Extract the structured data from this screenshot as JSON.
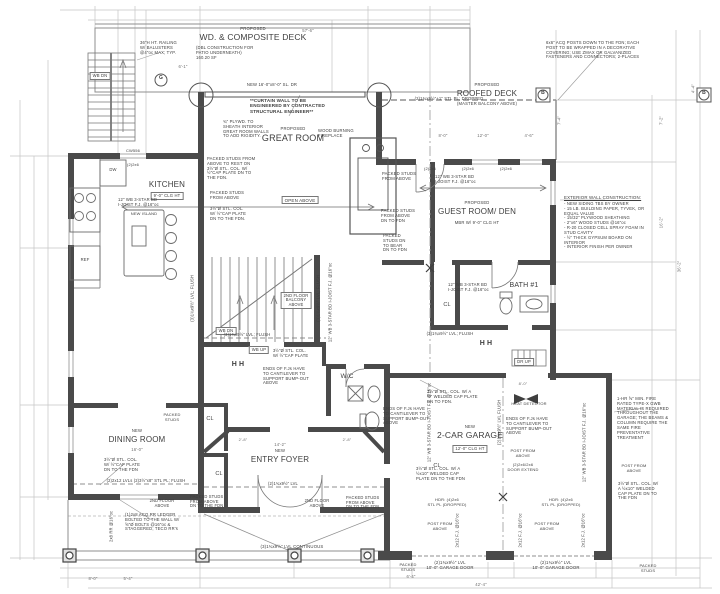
{
  "colors": {
    "paper": "#ffffff",
    "wall_ink": "#4a4a4a",
    "line": "#8f8f8f",
    "dim_line": "#c4c4c4",
    "text": "#3d3d3d"
  },
  "labels": [
    {
      "n": "deck-proposed",
      "t": "PROPOSED",
      "x": 253,
      "y": 27,
      "s": 4.3
    },
    {
      "n": "deck-title",
      "t": "WD. & COMPOSITE DECK",
      "x": 253,
      "y": 33,
      "s": 8.5
    },
    {
      "n": "deck-sub",
      "t": "(DBL CONSTRUCTION FOR\nPATIO UNDERNEATH)\n160.20 SF",
      "x": 236,
      "y": 46,
      "s": 4.2,
      "al": "l",
      "w": 80
    },
    {
      "n": "roofed-deck-proposed",
      "t": "PROPOSED",
      "x": 487,
      "y": 83,
      "s": 4.2
    },
    {
      "n": "roofed-deck-title",
      "t": "ROOFED DECK",
      "x": 487,
      "y": 89,
      "s": 8
    },
    {
      "n": "roofed-deck-sub",
      "t": "(MASTER BALCONY ABOVE)",
      "x": 487,
      "y": 102,
      "s": 4.2
    },
    {
      "n": "great-room-proposed",
      "t": "PROPOSED",
      "x": 293,
      "y": 127,
      "s": 4.2
    },
    {
      "n": "great-room-title",
      "t": "GREAT ROOM",
      "x": 293,
      "y": 133,
      "s": 9
    },
    {
      "n": "open-above-tag",
      "t": "OPEN ABOVE",
      "x": 300,
      "y": 196,
      "s": 4.5,
      "box": 1
    },
    {
      "n": "kitchen-title",
      "t": "KITCHEN",
      "x": 167,
      "y": 180,
      "s": 8
    },
    {
      "n": "kitchen-clg-tag",
      "t": "9'-0\" CLG HT",
      "x": 167,
      "y": 192,
      "s": 4.2,
      "box": 1
    },
    {
      "n": "guest-proposed",
      "t": "PROPOSED",
      "x": 477,
      "y": 201,
      "s": 4.2
    },
    {
      "n": "guest-title",
      "t": "GUEST ROOM/ DEN",
      "x": 477,
      "y": 207,
      "s": 8
    },
    {
      "n": "guest-sub",
      "t": "MBR W/ 9'-0\" CLG HT",
      "x": 477,
      "y": 221,
      "s": 4.2
    },
    {
      "n": "bath1-title",
      "t": "BATH #1",
      "x": 524,
      "y": 282,
      "s": 7
    },
    {
      "n": "dining-new",
      "t": "NEW",
      "x": 137,
      "y": 429,
      "s": 4.2
    },
    {
      "n": "dining-title",
      "t": "DINING ROOM",
      "x": 137,
      "y": 435,
      "s": 8
    },
    {
      "n": "dining-dim",
      "t": "16'-0\"",
      "x": 137,
      "y": 448,
      "s": 4.2,
      "k": "dim"
    },
    {
      "n": "foyer-dim",
      "t": "14'-2\"",
      "x": 280,
      "y": 443,
      "s": 4.2,
      "k": "dim"
    },
    {
      "n": "foyer-new",
      "t": "NEW",
      "x": 280,
      "y": 449,
      "s": 4.2
    },
    {
      "n": "foyer-title",
      "t": "ENTRY FOYER",
      "x": 280,
      "y": 455,
      "s": 8
    },
    {
      "n": "garage-new",
      "t": "NEW",
      "x": 470,
      "y": 425,
      "s": 4.2
    },
    {
      "n": "garage-title",
      "t": "2-CAR GARAGE",
      "x": 470,
      "y": 431,
      "s": 8.5
    },
    {
      "n": "garage-clg-tag",
      "t": "12'-0\" CLG HT",
      "x": 470,
      "y": 445,
      "s": 4.2,
      "box": 1
    },
    {
      "n": "wc-title",
      "t": "W/C",
      "x": 347,
      "y": 373,
      "s": 6.5
    },
    {
      "n": "closet-tag-1",
      "t": "CL",
      "x": 210,
      "y": 416,
      "s": 5.5
    },
    {
      "n": "closet-tag-2",
      "t": "CL",
      "x": 219,
      "y": 471,
      "s": 5.5
    },
    {
      "n": "closet-tag-3",
      "t": "CL",
      "x": 447,
      "y": 302,
      "s": 5.5
    },
    {
      "n": "closet-tag-4",
      "t": "CL",
      "x": 437,
      "y": 463,
      "s": 5.5
    },
    {
      "n": "stair-ext-wb-dn",
      "t": "WB DN",
      "x": 100,
      "y": 72,
      "s": 4.2,
      "box": 1
    },
    {
      "n": "stair-wb-dn",
      "t": "WB DN",
      "x": 226,
      "y": 327,
      "s": 4.2,
      "box": 1
    },
    {
      "n": "stair-wb-up",
      "t": "WB UP",
      "x": 259,
      "y": 346,
      "s": 4.2,
      "box": 1
    },
    {
      "n": "stair-dr-up",
      "t": "DR UP",
      "x": 524,
      "y": 358,
      "s": 4.2,
      "box": 1
    },
    {
      "n": "note-curtain-wall",
      "t": "**CURTAIN WALL TO BE\nENGINEERED BY CONTRACTED\nSTRUCTURAL ENGINEER**",
      "x": 289,
      "y": 98,
      "s": 4.6,
      "b": 1,
      "al": "l",
      "w": 78
    },
    {
      "n": "note-railing",
      "t": "36\"H HT. RAILING\nW/ BALUSTERS\n@4\"oc MAX; TYP.",
      "x": 163,
      "y": 41,
      "s": 4.2,
      "al": "l",
      "w": 46
    },
    {
      "n": "note-plywood",
      "t": "¾\" PLYWD. TO\nSHEATH INTERIOR\nGREAT ROOM WALLS\nTO ADD RIGIDITY.",
      "x": 247,
      "y": 120,
      "s": 4.2,
      "al": "l",
      "w": 48
    },
    {
      "n": "note-packed-col-great",
      "t": "PACKED STUDS FROM\nABOVE TO REST ON\n3½\"Ø STL. COL. W/\n½\"CAP PLATE DN TO\nTHE FDN.",
      "x": 232,
      "y": 157,
      "s": 4.2,
      "al": "l",
      "w": 50
    },
    {
      "n": "note-packed-above-1",
      "t": "PACKED STUDS\nFROM ABOVE",
      "x": 230,
      "y": 191,
      "s": 4.2,
      "al": "l",
      "w": 40
    },
    {
      "n": "note-col-cap-1",
      "t": "3½\"Ø STL. COL.\nW/ ½\"CAP PLATE\nDN TO THE FDN.",
      "x": 230,
      "y": 207,
      "s": 4.2,
      "al": "l",
      "w": 40
    },
    {
      "n": "note-fireplace",
      "t": "WOOD BURNING\nFIREPLACE",
      "x": 337,
      "y": 129,
      "s": 4.2,
      "al": "l",
      "w": 38
    },
    {
      "n": "note-packed-above-2",
      "t": "PACKED STUDS\nFROM ABOVE",
      "x": 401,
      "y": 172,
      "s": 4.2,
      "al": "l",
      "w": 38
    },
    {
      "n": "note-packed-above-3",
      "t": "PACKED STUDS\nFROM ABOVE\nDN TO FDN",
      "x": 400,
      "y": 209,
      "s": 4.2,
      "al": "l",
      "w": 38
    },
    {
      "n": "note-packed-bear",
      "t": "PACKED\nSTUDS DN\nTO BEAR\nDN TO FDN",
      "x": 398,
      "y": 234,
      "s": 4.2,
      "al": "l",
      "w": 30
    },
    {
      "n": "note-sliding-door",
      "t": "NEW 16'-0\"x8'-0\" SL. DR",
      "x": 272,
      "y": 83,
      "s": 4.2
    },
    {
      "n": "note-dropped-plate",
      "t": "(2)1¾x9½\"+1\" STL PL; DROPPED",
      "x": 449,
      "y": 97,
      "s": 4.2
    },
    {
      "n": "note-acq-posts",
      "t": "6x6\" ACQ POSTS DOWN TO THE FDN; EACH\nPOST TO BE WRAPPED IN A DECORATIVE\nCOVERING; USE ZMAX OR GALVANIZED\nFASTENERS AND CONNECTORS; 2-PLACES",
      "x": 601,
      "y": 41,
      "s": 4.2,
      "al": "l",
      "w": 110
    },
    {
      "n": "note-extwall-title",
      "t": "EXTERIOR WALL CONSTRUCTION:",
      "x": 607,
      "y": 195,
      "s": 4.4,
      "u": 1,
      "al": "l",
      "w": 86
    },
    {
      "n": "note-extwall-body",
      "t": "- NEW SIDING TBS BY OWNER\n- 15 LB. BUILDING PAPER, TYVEK, OR\n  EQUAL VALUE\n- 15/32\" PLYWOOD SHEATHING\n- 2\"x6\" WOOD STUDS @16\"oc\n- R-20 CLOSED CELL SPRAY FOAM IN\n  STUD CAVITY\n- ½\" THICK GYPSUM BOARD ON INTERIOR\n- INTERIOR FINISH PER OWNER",
      "x": 607,
      "y": 202,
      "s": 4.2,
      "al": "l",
      "w": 86
    },
    {
      "n": "note-joist-kitchen",
      "t": "12\" WB 3-STAR BD\nI-JOIST F.J. @16\"oc",
      "x": 140,
      "y": 198,
      "s": 4.2,
      "al": "l",
      "w": 44
    },
    {
      "n": "note-joist-guest",
      "t": "12\" WB 3-STAR BD\nI-JOIST F.J. @16\"oc",
      "x": 457,
      "y": 175,
      "s": 4.2,
      "al": "l",
      "w": 44
    },
    {
      "n": "note-joist-hall",
      "t": "12\" WB 3-STAR BD\nI-JOIST F.J. @16\"oc",
      "x": 470,
      "y": 283,
      "s": 4.2,
      "al": "l",
      "w": 44
    },
    {
      "n": "note-joist-stair",
      "t": "12\" WB 3-STAR BD  I-JOIST F.J. @16\"oc",
      "x": 331,
      "y": 300,
      "s": 4.1,
      "r": -90
    },
    {
      "n": "note-joist-garage-left",
      "t": "12\" WB 3-STAR BD  I-JOIST F.J. @16\"oc",
      "x": 430,
      "y": 420,
      "s": 4.1,
      "r": -90
    },
    {
      "n": "note-joist-garage-right",
      "t": "12\" WB 3-STAR BD  I-JOIST F.J. @16\"oc",
      "x": 585,
      "y": 440,
      "s": 4.1,
      "r": -90
    },
    {
      "n": "note-cantilever-1",
      "t": "ENDS OF F.Js HAVE\nTO CANTILEVER TO\nSUPPORT BUMP-OUT\nABOVE",
      "x": 287,
      "y": 367,
      "s": 4.2,
      "al": "l",
      "w": 48
    },
    {
      "n": "note-cantilever-2",
      "t": "ENDS OF F.Js HAVE\nTO CANTILEVER TO\nSUPPORT BUMP-OUT\nABOVE",
      "x": 407,
      "y": 407,
      "s": 4.2,
      "al": "l",
      "w": 48
    },
    {
      "n": "note-cantilever-3",
      "t": "ENDS OF F.Js HAVE\nTO CANTILEVER TO\nSUPPORT BUMP-OUT\nABOVE",
      "x": 530,
      "y": 417,
      "s": 4.2,
      "al": "l",
      "w": 48
    },
    {
      "n": "heat-detector-label",
      "t": "HEAT DETECTOR",
      "x": 529,
      "y": 402,
      "s": 4
    },
    {
      "n": "note-fire-rated",
      "t": "1-HR ⅝\" MIN. FIRE\nRATED TYPE-X GWB\nMATERIAL IS REQUIRED\nTHROUGHOUT THE\nGARAGE; THE BEAMS &\nCOLUMN REQUIRE THE\nSAME FIRE\nPREVENTATIVE\nTREATMENT",
      "x": 645,
      "y": 397,
      "s": 4.2,
      "al": "l",
      "w": 56
    },
    {
      "n": "note-post-above-1",
      "t": "POST FROM\nABOVE",
      "x": 523,
      "y": 449,
      "s": 4
    },
    {
      "n": "note-door-extend",
      "t": "(2)2x6/2x6\nDOOR EXTEND",
      "x": 523,
      "y": 463,
      "s": 4
    },
    {
      "n": "note-post-above-2",
      "t": "POST FROM\nABOVE",
      "x": 440,
      "y": 522,
      "s": 4
    },
    {
      "n": "note-post-above-3",
      "t": "POST FROM\nABOVE",
      "x": 547,
      "y": 522,
      "s": 4
    },
    {
      "n": "note-post-above-4",
      "t": "POST FROM\nABOVE",
      "x": 634,
      "y": 464,
      "s": 4
    },
    {
      "n": "note-col-cap-2",
      "t": "3½\"Ø STL. COL. W/ A\n½\" WELDED CAP PLATE\nDN TO FDN.",
      "x": 453,
      "y": 390,
      "s": 4.2,
      "al": "l",
      "w": 52
    },
    {
      "n": "note-col-cap-3",
      "t": "3½\"Ø STL. COL. W/ A\n½x10\" WELDED CAP\nPLATE DN TO THE FDN",
      "x": 441,
      "y": 467,
      "s": 4.2,
      "al": "l",
      "w": 50
    },
    {
      "n": "note-col-cap-4",
      "t": "3½\"Ø STL. COL. W/\nA ½x10\" WELDED\nCAP PLATE DN TO\nTHE FDN",
      "x": 641,
      "y": 482,
      "s": 4.2,
      "al": "l",
      "w": 46
    },
    {
      "n": "note-col-cap-5",
      "t": "3½\"Ø STL. COL.\nW/ ½\"CAP PLATE\nDN TO THE FDN",
      "x": 124,
      "y": 458,
      "s": 4.2,
      "al": "l",
      "w": 40
    },
    {
      "n": "note-flush-2x12",
      "t": "(2)2x12 LVLs (2)3½\"x8\" STL PL; FLUSH",
      "x": 146,
      "y": 479,
      "s": 4.1
    },
    {
      "n": "note-lvl-flush-a",
      "t": "(3)1¾x9½\" LVL; FLUSH",
      "x": 247,
      "y": 333,
      "s": 4.1
    },
    {
      "n": "note-lvl-flush-b",
      "t": "(3)1¾x9½\" LVL; FLUSH",
      "x": 450,
      "y": 332,
      "s": 4.1
    },
    {
      "n": "note-col-cap-6",
      "t": "3½\"Ø STL. COL.\nW/ ½\"CAP PLATE",
      "x": 293,
      "y": 349,
      "s": 4.1,
      "al": "l",
      "w": 40
    },
    {
      "n": "note-lvl-rot-a",
      "t": "(3)1¾x9½\" LVL; FLUSH",
      "x": 193,
      "y": 296,
      "s": 4.1,
      "r": -90
    },
    {
      "n": "note-lvl-rot-b",
      "t": "(3)1¾x9½\" LVL; FLUSH",
      "x": 319,
      "y": 296,
      "s": 4.1,
      "r": -90
    },
    {
      "n": "note-balcony-above",
      "t": "2ND FLOOR\nBALCONY\nABOVE",
      "x": 296,
      "y": 292,
      "s": 4.1,
      "box": 1
    },
    {
      "n": "note-2nd-floor-1",
      "t": "2ND FLOOR\nABOVE",
      "x": 162,
      "y": 499,
      "s": 4.1
    },
    {
      "n": "note-2nd-floor-2",
      "t": "2ND FLOOR\nABOVE",
      "x": 317,
      "y": 499,
      "s": 4.1
    },
    {
      "n": "note-packed-fdn-1",
      "t": "PACKED STUDS\nFROM ABOVE\nDN TO THE FDN",
      "x": 209,
      "y": 495,
      "s": 4.1,
      "al": "l",
      "w": 38
    },
    {
      "n": "note-packed-fdn-2",
      "t": "PACKED STUDS\nFROM ABOVE\nDN TO THE FDN",
      "x": 365,
      "y": 496,
      "s": 4.1,
      "al": "l",
      "w": 38
    },
    {
      "n": "note-packed-studs-1",
      "t": "PACKED\nSTUDS",
      "x": 172,
      "y": 413,
      "s": 4
    },
    {
      "n": "note-packed-studs-2",
      "t": "PACKED\nSTUDS",
      "x": 408,
      "y": 563,
      "s": 4
    },
    {
      "n": "note-packed-studs-3",
      "t": "PACKED\nSTUDS",
      "x": 648,
      "y": 564,
      "s": 4
    },
    {
      "n": "note-ledger",
      "t": "(1)2x8 ACQ RR LEDGER\nBOLTED TO THE WALL W/\n⅝\"Ø BOLTS @16\"oc &\nSTAGGERED; TECO RR's",
      "x": 154,
      "y": 513,
      "s": 4.2,
      "al": "l",
      "w": 58
    },
    {
      "n": "note-rr-rot",
      "t": "2x8 RR @16\"oc",
      "x": 112,
      "y": 524,
      "s": 4.1,
      "r": -90
    },
    {
      "n": "note-porch-lvl",
      "t": "(3)1¾x9½\" LVL CONTINUOUS",
      "x": 292,
      "y": 545,
      "s": 4.3
    },
    {
      "n": "note-garage-door-1",
      "t": "(2)1¾x9½\" LVL\n10'-0\" GARAGE DOOR",
      "x": 450,
      "y": 561,
      "s": 4.3
    },
    {
      "n": "note-garage-door-2",
      "t": "(2)1¾x9½\" LVL\n10'-0\" GARAGE DOOR",
      "x": 556,
      "y": 561,
      "s": 4.3
    },
    {
      "n": "note-header-1",
      "t": "HDR: (4)2x6\nSTL PL (DROPPED)",
      "x": 447,
      "y": 498,
      "s": 4
    },
    {
      "n": "note-header-2",
      "t": "HDR: (4)2x6\nSTL PL (DROPPED)",
      "x": 561,
      "y": 498,
      "s": 4
    },
    {
      "n": "note-fj-rot-1",
      "t": "2x12 F.J. @16\"oc",
      "x": 458,
      "y": 528,
      "s": 4.1,
      "r": -90
    },
    {
      "n": "note-fj-rot-2",
      "t": "2x12 F.J. @16\"oc",
      "x": 521,
      "y": 528,
      "s": 4.1,
      "r": -90
    },
    {
      "n": "note-fj-rot-3",
      "t": "2x12 F.J. @16\"oc",
      "x": 584,
      "y": 528,
      "s": 4.1,
      "r": -90
    },
    {
      "n": "note-garage-centerline",
      "t": "(2)1¾x9½\" LVL FLUSH",
      "x": 500,
      "y": 420,
      "s": 4.1,
      "r": -90
    },
    {
      "n": "note-foyer-lvl",
      "t": "(2)1¾x9½\" LVL",
      "x": 283,
      "y": 482,
      "s": 4.1
    },
    {
      "n": "window-tag-kitchen",
      "t": "CW556",
      "x": 133,
      "y": 149,
      "s": 4
    },
    {
      "n": "header-tag-a",
      "t": "(2)2x6",
      "x": 133,
      "y": 163,
      "s": 3.9
    },
    {
      "n": "header-tag-b",
      "t": "(2)2x6",
      "x": 430,
      "y": 167,
      "s": 3.9
    },
    {
      "n": "header-tag-c",
      "t": "(2)2x6",
      "x": 468,
      "y": 167,
      "s": 3.9
    },
    {
      "n": "header-tag-d",
      "t": "(2)2x6",
      "x": 506,
      "y": 167,
      "s": 3.9
    },
    {
      "n": "beam-section-symbol-1",
      "t": "H  H",
      "x": 238,
      "y": 361,
      "s": 7,
      "b": 1
    },
    {
      "n": "beam-section-symbol-2",
      "t": "H  H",
      "x": 486,
      "y": 340,
      "s": 7,
      "b": 1
    },
    {
      "n": "grid-bubble-g-label",
      "t": "G",
      "x": 161,
      "y": 76,
      "s": 5,
      "b": 1
    },
    {
      "n": "grid-bubble-b1-label",
      "t": "B",
      "x": 543,
      "y": 91,
      "s": 5,
      "b": 1
    },
    {
      "n": "grid-bubble-b2-label",
      "t": "B",
      "x": 704,
      "y": 91,
      "s": 5,
      "b": 1
    },
    {
      "n": "appliance-dw-label",
      "t": "DW",
      "x": 113,
      "y": 168,
      "s": 4.2
    },
    {
      "n": "appliance-ref-label",
      "t": "REF",
      "x": 85,
      "y": 258,
      "s": 4.2
    },
    {
      "n": "island-label",
      "t": "NEW ISLAND",
      "x": 144,
      "y": 212,
      "s": 4
    },
    {
      "n": "dim-top-overall",
      "t": "57'-6\"",
      "x": 308,
      "y": 29,
      "s": 4.2,
      "k": "dim"
    },
    {
      "n": "dim-stair-ext",
      "t": "6'-1\"",
      "x": 183,
      "y": 65,
      "s": 4.2,
      "k": "dim"
    },
    {
      "n": "dim-roofdeck-1",
      "t": "8'-0\"",
      "x": 443,
      "y": 134,
      "s": 4.2,
      "k": "dim"
    },
    {
      "n": "dim-roofdeck-2",
      "t": "12'-0\"",
      "x": 483,
      "y": 134,
      "s": 4.2,
      "k": "dim"
    },
    {
      "n": "dim-roofdeck-3",
      "t": "4'-6\"",
      "x": 529,
      "y": 134,
      "s": 4.2,
      "k": "dim"
    },
    {
      "n": "dim-roofdeck-v",
      "t": "7'-4\"",
      "x": 560,
      "y": 118,
      "s": 4.2,
      "k": "dim",
      "r": -90
    },
    {
      "n": "dim-right-1",
      "t": "4'-4\"",
      "x": 694,
      "y": 86,
      "s": 4.2,
      "k": "dim",
      "r": -90
    },
    {
      "n": "dim-right-2",
      "t": "7'-2\"",
      "x": 662,
      "y": 118,
      "s": 4.2,
      "k": "dim",
      "r": -90
    },
    {
      "n": "dim-right-3",
      "t": "16'-2\"",
      "x": 662,
      "y": 220,
      "s": 4.2,
      "k": "dim",
      "r": -90
    },
    {
      "n": "dim-right-4",
      "t": "36'-2\"",
      "x": 680,
      "y": 264,
      "s": 4.2,
      "k": "dim",
      "r": -90
    },
    {
      "n": "dim-foyer-left",
      "t": "2'-8\"",
      "x": 243,
      "y": 438,
      "s": 4,
      "k": "dim"
    },
    {
      "n": "dim-foyer-right",
      "t": "2'-8\"",
      "x": 347,
      "y": 438,
      "s": 4,
      "k": "dim"
    },
    {
      "n": "dim-garage-top",
      "t": "8'-0\"",
      "x": 523,
      "y": 382,
      "s": 4,
      "k": "dim"
    },
    {
      "n": "dim-bottom-1",
      "t": "8'-0\"",
      "x": 93,
      "y": 577,
      "s": 4.2,
      "k": "dim"
    },
    {
      "n": "dim-bottom-2",
      "t": "5'-4\"",
      "x": 128,
      "y": 577,
      "s": 4.2,
      "k": "dim"
    },
    {
      "n": "dim-bottom-3",
      "t": "6'-4\"",
      "x": 411,
      "y": 575,
      "s": 4.2,
      "k": "dim"
    },
    {
      "n": "dim-bottom-4",
      "t": "42'-4\"",
      "x": 481,
      "y": 583,
      "s": 4.2,
      "k": "dim"
    }
  ]
}
